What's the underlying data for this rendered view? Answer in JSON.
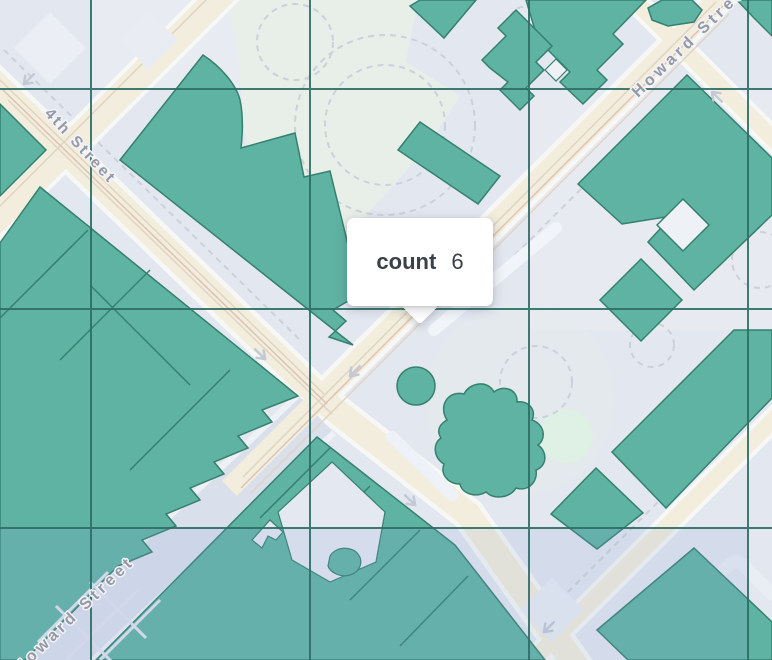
{
  "map": {
    "description": "Map visualization with aggregation grid overlay and hover tooltip",
    "streets": {
      "fourth": {
        "label": "4th Street"
      },
      "howard_upper": {
        "label": "Howard Street"
      },
      "howard_lower": {
        "label": "Howard Street"
      }
    },
    "tooltip": {
      "label": "count",
      "value": "6"
    },
    "overlay_grid": {
      "column_lines_x": [
        91,
        310,
        529,
        748
      ],
      "row_lines_y": [
        89,
        309,
        528
      ],
      "line_color": "#2e6d65",
      "highlighted_row_tint": "rgba(138,164,214,0.16)"
    },
    "colors": {
      "land": "#e3e7f0",
      "park": "#e7efe8",
      "building_fill": "#5fb3a2",
      "building_outline": "#35806f",
      "road_major_fill": "#f2eddc",
      "road_blue_fill": "#d9e0ec",
      "road_casing": "#f7f8f5",
      "path_dashed": "#cbd1db",
      "street_label_text": "#9598a6",
      "tooltip_background": "#ffffff",
      "tooltip_text": "#3b4148"
    }
  }
}
